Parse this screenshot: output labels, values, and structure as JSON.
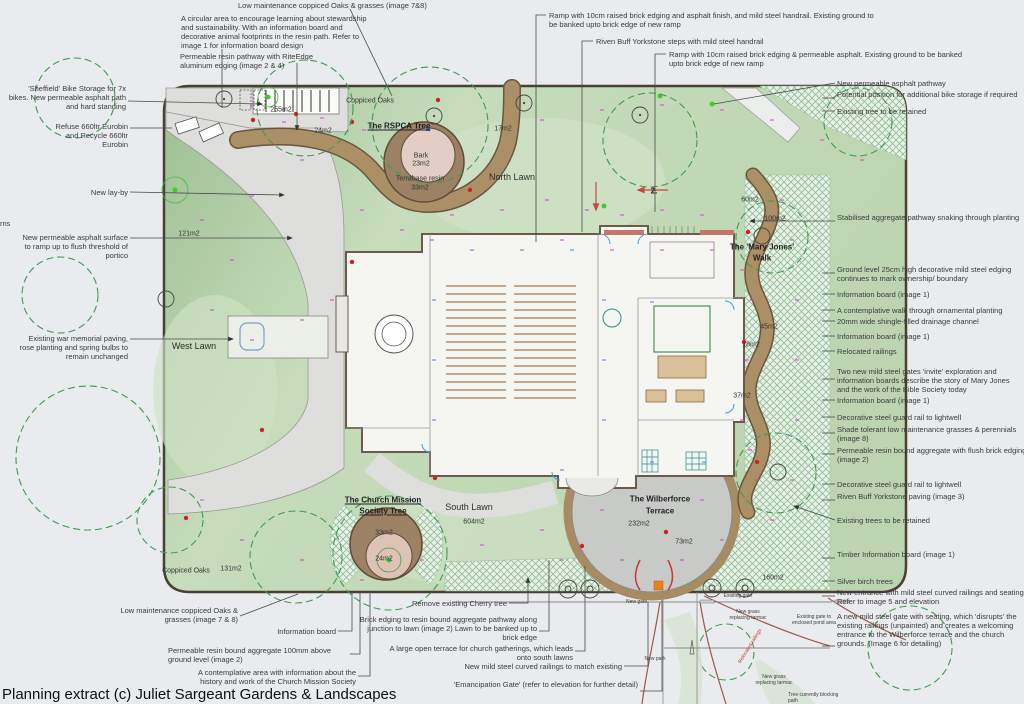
{
  "footer": {
    "credit": "Planning extract (c) Juliet Sargeant Gardens & Landscapes"
  },
  "colors": {
    "page_bg": "#e9ebef",
    "lawn": "#bdd6b1",
    "boundary": "#4a3f33",
    "grey_path": "#dedfdc",
    "brown_path": "#ab8f66",
    "terrace": "#c8cac8",
    "hatch": "#e9f2e6",
    "building": "#f5f5f2",
    "wall": "#6e594d",
    "red_dot": "#cc2222",
    "green_dot": "#3ecc2e",
    "magenta": "#d13fd1",
    "annotation": "#3b3b3b",
    "canopy": "#3f9b4f"
  },
  "annotations": [
    {
      "text": "Low maintenance coppiced Oaks & grasses (image 7&8)",
      "x": 238,
      "y": 1,
      "w": 220,
      "align": "left",
      "leader": [
        350,
        9,
        392,
        96
      ]
    },
    {
      "text": "A circular area to encourage learning about stewardship and sustainability. With an information board and decorative animal footprints in the resin path. Refer to image 1 for information board design",
      "x": 181,
      "y": 14,
      "w": 198,
      "align": "left",
      "leader": [
        222,
        49,
        222,
        108
      ]
    },
    {
      "text": "Permeable resin pathway with RiteEdge aluminum edging (image 2 & 4)",
      "x": 180,
      "y": 52,
      "w": 150,
      "align": "left",
      "leader": [
        297,
        63,
        297,
        130
      ],
      "arrow": true
    },
    {
      "text": "Ramp with 10cm raised brick edging and asphalt finish, and mild steel handrail. Existing ground to be banked upto brick edge of new ramp",
      "x": 549,
      "y": 11,
      "w": 335,
      "align": "left",
      "leader": [
        546,
        15,
        536,
        15,
        536,
        242
      ]
    },
    {
      "text": "Riven Buff Yorkstone steps with mild steel handrail",
      "x": 596,
      "y": 37,
      "w": 260,
      "align": "left",
      "leader": [
        593,
        41,
        582,
        41,
        582,
        232
      ]
    },
    {
      "text": "Ramp with 10cm raised brick edging & permeable asphalt. Existing ground to be banked upto brick edge of new ramp",
      "x": 669,
      "y": 50,
      "w": 295,
      "align": "left",
      "leader": [
        666,
        54,
        655,
        54,
        655,
        212
      ]
    },
    {
      "text": "'Sheffield' Bike Storage for 7x bikes. New permeable asphalt path and hard standing",
      "x": 8,
      "y": 84,
      "w": 118,
      "align": "right",
      "leader": [
        128,
        101,
        262,
        104
      ],
      "arrow": true
    },
    {
      "text": "Refuse 660ltr Eurobin and Recycle 660ltr Eurobin",
      "x": 44,
      "y": 122,
      "w": 84,
      "align": "right",
      "leader": [
        130,
        128,
        172,
        128
      ]
    },
    {
      "text": "New lay-by",
      "x": 62,
      "y": 188,
      "w": 66,
      "align": "right",
      "leader": [
        130,
        192,
        284,
        195
      ],
      "arrow": true
    },
    {
      "text": "rns",
      "x": 0,
      "y": 219,
      "w": 22,
      "align": "left"
    },
    {
      "text": "New permeable asphalt surface to ramp up to flush threshold of portico",
      "x": 18,
      "y": 233,
      "w": 110,
      "align": "right",
      "leader": [
        130,
        238,
        292,
        238
      ],
      "arrow": true
    },
    {
      "text": "Existing war memorial paving, rose planting and spring bulbs to remain unchanged",
      "x": 18,
      "y": 334,
      "w": 110,
      "align": "right",
      "leader": [
        130,
        339,
        233,
        339
      ],
      "arrow": true
    },
    {
      "text": "New permeable asphalt pathway",
      "x": 837,
      "y": 79,
      "w": 182,
      "align": "left",
      "leader": [
        835,
        83,
        714,
        104
      ]
    },
    {
      "text": "Potential position for additional bike storage if required",
      "x": 837,
      "y": 90,
      "w": 182,
      "align": "left",
      "leader": [
        835,
        98,
        822,
        98
      ]
    },
    {
      "text": "Existing tree to be retained",
      "x": 837,
      "y": 107,
      "w": 182,
      "align": "left",
      "leader": [
        835,
        111,
        822,
        111
      ]
    },
    {
      "text": "Stabilised aggregate pathway snaking through planting",
      "x": 837,
      "y": 213,
      "w": 185,
      "align": "left",
      "leader": [
        835,
        221,
        750,
        221
      ],
      "arrow": true
    },
    {
      "text": "Ground level 25cm high decorative mild steel edging continues to mark ownership/ boundary",
      "x": 837,
      "y": 265,
      "w": 185,
      "align": "left",
      "leader": [
        835,
        273,
        822,
        273
      ]
    },
    {
      "text": "Information board (image 1)",
      "x": 837,
      "y": 290,
      "w": 182,
      "align": "left",
      "leader": [
        835,
        294,
        822,
        294
      ]
    },
    {
      "text": "A contemplative walk through ornamental planting",
      "x": 837,
      "y": 306,
      "w": 190,
      "align": "left",
      "leader": [
        835,
        310,
        822,
        310
      ]
    },
    {
      "text": "20mm wide shingle-filled drainage channel",
      "x": 837,
      "y": 317,
      "w": 190,
      "align": "left",
      "leader": [
        835,
        321,
        822,
        321
      ]
    },
    {
      "text": "Information board (image 1)",
      "x": 837,
      "y": 332,
      "w": 182,
      "align": "left",
      "leader": [
        835,
        336,
        822,
        336
      ]
    },
    {
      "text": "Relocated railings",
      "x": 837,
      "y": 347,
      "w": 182,
      "align": "left",
      "leader": [
        835,
        351,
        822,
        351
      ]
    },
    {
      "text": "Two new mild steel gates 'invite' exploration and information boards describe the story of Mary Jones and the work of the Bible Society today",
      "x": 837,
      "y": 367,
      "w": 185,
      "align": "left",
      "leader": [
        835,
        379,
        822,
        379
      ]
    },
    {
      "text": "Information board (image 1)",
      "x": 837,
      "y": 396,
      "w": 182,
      "align": "left",
      "leader": [
        835,
        400,
        822,
        400
      ]
    },
    {
      "text": "Decorative steel guard rail to lightwell",
      "x": 837,
      "y": 413,
      "w": 185,
      "align": "left",
      "leader": [
        835,
        417,
        822,
        417
      ]
    },
    {
      "text": "Shade tolerant low maintenance grasses & perennials (image 8)",
      "x": 837,
      "y": 425,
      "w": 190,
      "align": "left",
      "leader": [
        835,
        433,
        822,
        433
      ]
    },
    {
      "text": "Permeable resin bound aggregate with flush brick edging (image 2)",
      "x": 837,
      "y": 446,
      "w": 190,
      "align": "left",
      "leader": [
        835,
        454,
        822,
        454
      ]
    },
    {
      "text": "Decorative steel guard rail to lightwell",
      "x": 837,
      "y": 480,
      "w": 185,
      "align": "left",
      "leader": [
        835,
        484,
        822,
        484
      ]
    },
    {
      "text": "Riven Buff Yorkstone paving (image 3)",
      "x": 837,
      "y": 492,
      "w": 185,
      "align": "left",
      "leader": [
        835,
        500,
        822,
        500
      ]
    },
    {
      "text": "Existing trees to be retained",
      "x": 837,
      "y": 516,
      "w": 185,
      "align": "left",
      "leader": [
        835,
        520,
        794,
        506
      ],
      "arrow": true
    },
    {
      "text": "Timber Information board (image 1)",
      "x": 837,
      "y": 550,
      "w": 185,
      "align": "left",
      "leader": [
        835,
        558,
        822,
        558
      ]
    },
    {
      "text": "Silver birch trees",
      "x": 837,
      "y": 577,
      "w": 185,
      "align": "left",
      "leader": [
        835,
        581,
        822,
        581
      ]
    },
    {
      "text": "New entrance with mild steel curved railings and seating. Refer to image 5 and elevation",
      "x": 837,
      "y": 588,
      "w": 190,
      "align": "left",
      "leader": [
        835,
        596,
        822,
        596
      ]
    },
    {
      "text": "A new mild steel gate with seating, which 'disrupts' the existing railings (unpainted) and creates a welcoming entrance to the Wilberforce terrace and the church grounds. (Image 6 for detailing)",
      "x": 837,
      "y": 612,
      "w": 190,
      "align": "left",
      "leader": [
        835,
        646,
        822,
        646
      ]
    },
    {
      "text": "Low maintenance coppiced Oaks & grasses (image 7 & 8)",
      "x": 100,
      "y": 606,
      "w": 138,
      "align": "right",
      "leader": [
        240,
        616,
        298,
        594
      ]
    },
    {
      "text": "Information board",
      "x": 256,
      "y": 627,
      "w": 80,
      "align": "right",
      "leader": [
        338,
        631,
        352,
        631,
        352,
        592
      ]
    },
    {
      "text": "Permeable resin bound aggregate 100mm above ground level (image 2)",
      "x": 168,
      "y": 646,
      "w": 188,
      "align": "left",
      "leader": [
        350,
        654,
        360,
        654,
        360,
        592
      ]
    },
    {
      "text": "A contemplative area with information about the history and work of the Church Mission Society",
      "x": 188,
      "y": 668,
      "w": 168,
      "align": "right",
      "leader": [
        358,
        676,
        370,
        676,
        370,
        592
      ]
    },
    {
      "text": "Remove existing Cherry tree",
      "x": 335,
      "y": 599,
      "w": 172,
      "align": "right",
      "leader": [
        509,
        603,
        528,
        603,
        528,
        578
      ],
      "arrow": true
    },
    {
      "text": "Brick edging to resin bound aggregate pathway along junction to lawn (image 2) Lawn to be banked up to brick edge",
      "x": 352,
      "y": 615,
      "w": 185,
      "align": "right",
      "leader": [
        539,
        631,
        549,
        631,
        549,
        560
      ]
    },
    {
      "text": "A large open terrace for church gatherings, which leads onto south lawns",
      "x": 385,
      "y": 644,
      "w": 188,
      "align": "right",
      "leader": [
        575,
        651,
        585,
        651,
        585,
        566
      ]
    },
    {
      "text": "New mild steel curved railings to match existing",
      "x": 420,
      "y": 662,
      "w": 202,
      "align": "right",
      "leader": [
        624,
        666,
        648,
        666,
        648,
        602
      ]
    },
    {
      "text": "'Emancipation Gate' (refer to elevation for further detail)",
      "x": 432,
      "y": 680,
      "w": 206,
      "align": "right",
      "leader": [
        640,
        691,
        662,
        691,
        662,
        600
      ]
    },
    {
      "text": "New gate",
      "x": 626,
      "y": 600,
      "w": 32,
      "align": "left",
      "cls": "small"
    },
    {
      "text": "Existing gate",
      "x": 718,
      "y": 594,
      "w": 40,
      "align": "center",
      "cls": "small"
    },
    {
      "text": "New grass replacing tarmac",
      "x": 726,
      "y": 610,
      "w": 44,
      "align": "center",
      "cls": "small"
    },
    {
      "text": "Existing gate to enclosed pond area",
      "x": 790,
      "y": 615,
      "w": 48,
      "align": "center",
      "cls": "small"
    },
    {
      "text": "New path",
      "x": 638,
      "y": 657,
      "w": 34,
      "align": "center",
      "cls": "small"
    },
    {
      "text": "New grass replacing tarmac",
      "x": 752,
      "y": 675,
      "w": 44,
      "align": "center",
      "cls": "small"
    },
    {
      "text": "Tree currently blocking path",
      "x": 788,
      "y": 693,
      "w": 52,
      "align": "left",
      "cls": "small"
    },
    {
      "text": "Relocated railings",
      "x": 738,
      "y": 662,
      "w": 60,
      "align": "left",
      "cls": "small red rot"
    }
  ],
  "plan_labels": [
    {
      "text": "Coppiced Oaks",
      "x": 370,
      "y": 101,
      "style": "area"
    },
    {
      "text": "The RSPCA Tree",
      "x": 399,
      "y": 126,
      "style": "title"
    },
    {
      "text": "Bark",
      "x": 421,
      "y": 156,
      "style": "area"
    },
    {
      "text": "23m2",
      "x": 421,
      "y": 164,
      "style": "area"
    },
    {
      "text": "Terrabase resin",
      "x": 420,
      "y": 179,
      "style": "area"
    },
    {
      "text": "33m2",
      "x": 420,
      "y": 188,
      "style": "area"
    },
    {
      "text": "North Lawn",
      "x": 512,
      "y": 177,
      "style": "lawn"
    },
    {
      "text": "17m2",
      "x": 503,
      "y": 129,
      "style": "area"
    },
    {
      "text": "255m2",
      "x": 281,
      "y": 110,
      "style": "area"
    },
    {
      "text": "24m2",
      "x": 323,
      "y": 131,
      "style": "area"
    },
    {
      "text": "121m2",
      "x": 189,
      "y": 234,
      "style": "area"
    },
    {
      "text": "West Lawn",
      "x": 194,
      "y": 346,
      "style": "lawn"
    },
    {
      "text": "Coppiced Oaks",
      "x": 186,
      "y": 571,
      "style": "area"
    },
    {
      "text": "131m2",
      "x": 231,
      "y": 569,
      "style": "area"
    },
    {
      "text": "The Church Mission",
      "x": 383,
      "y": 500,
      "style": "title"
    },
    {
      "text": "Society Tree",
      "x": 383,
      "y": 511,
      "style": "title"
    },
    {
      "text": "South Lawn",
      "x": 469,
      "y": 507,
      "style": "lawn"
    },
    {
      "text": "604m2",
      "x": 474,
      "y": 522,
      "style": "area"
    },
    {
      "text": "33m2",
      "x": 384,
      "y": 533,
      "style": "area"
    },
    {
      "text": "24m2",
      "x": 384,
      "y": 559,
      "style": "area"
    },
    {
      "text": "The Wilberforce",
      "x": 660,
      "y": 499,
      "style": "bold"
    },
    {
      "text": "Terrace",
      "x": 660,
      "y": 511,
      "style": "bold"
    },
    {
      "text": "232m2",
      "x": 639,
      "y": 524,
      "style": "area"
    },
    {
      "text": "73m2",
      "x": 684,
      "y": 542,
      "style": "area"
    },
    {
      "text": "160m2",
      "x": 773,
      "y": 578,
      "style": "area"
    },
    {
      "text": "The 'Mary Jones'",
      "x": 762,
      "y": 247,
      "style": "bold"
    },
    {
      "text": "Walk",
      "x": 762,
      "y": 258,
      "style": "bold"
    },
    {
      "text": "60m2",
      "x": 750,
      "y": 200,
      "style": "area"
    },
    {
      "text": "100m2",
      "x": 775,
      "y": 219,
      "style": "area"
    },
    {
      "text": "45m2",
      "x": 769,
      "y": 327,
      "style": "area"
    },
    {
      "text": "18m2",
      "x": 751,
      "y": 345,
      "style": "area"
    },
    {
      "text": "37m2",
      "x": 742,
      "y": 396,
      "style": "area"
    },
    {
      "text": "2.",
      "x": 654,
      "y": 191,
      "style": "bold"
    }
  ]
}
